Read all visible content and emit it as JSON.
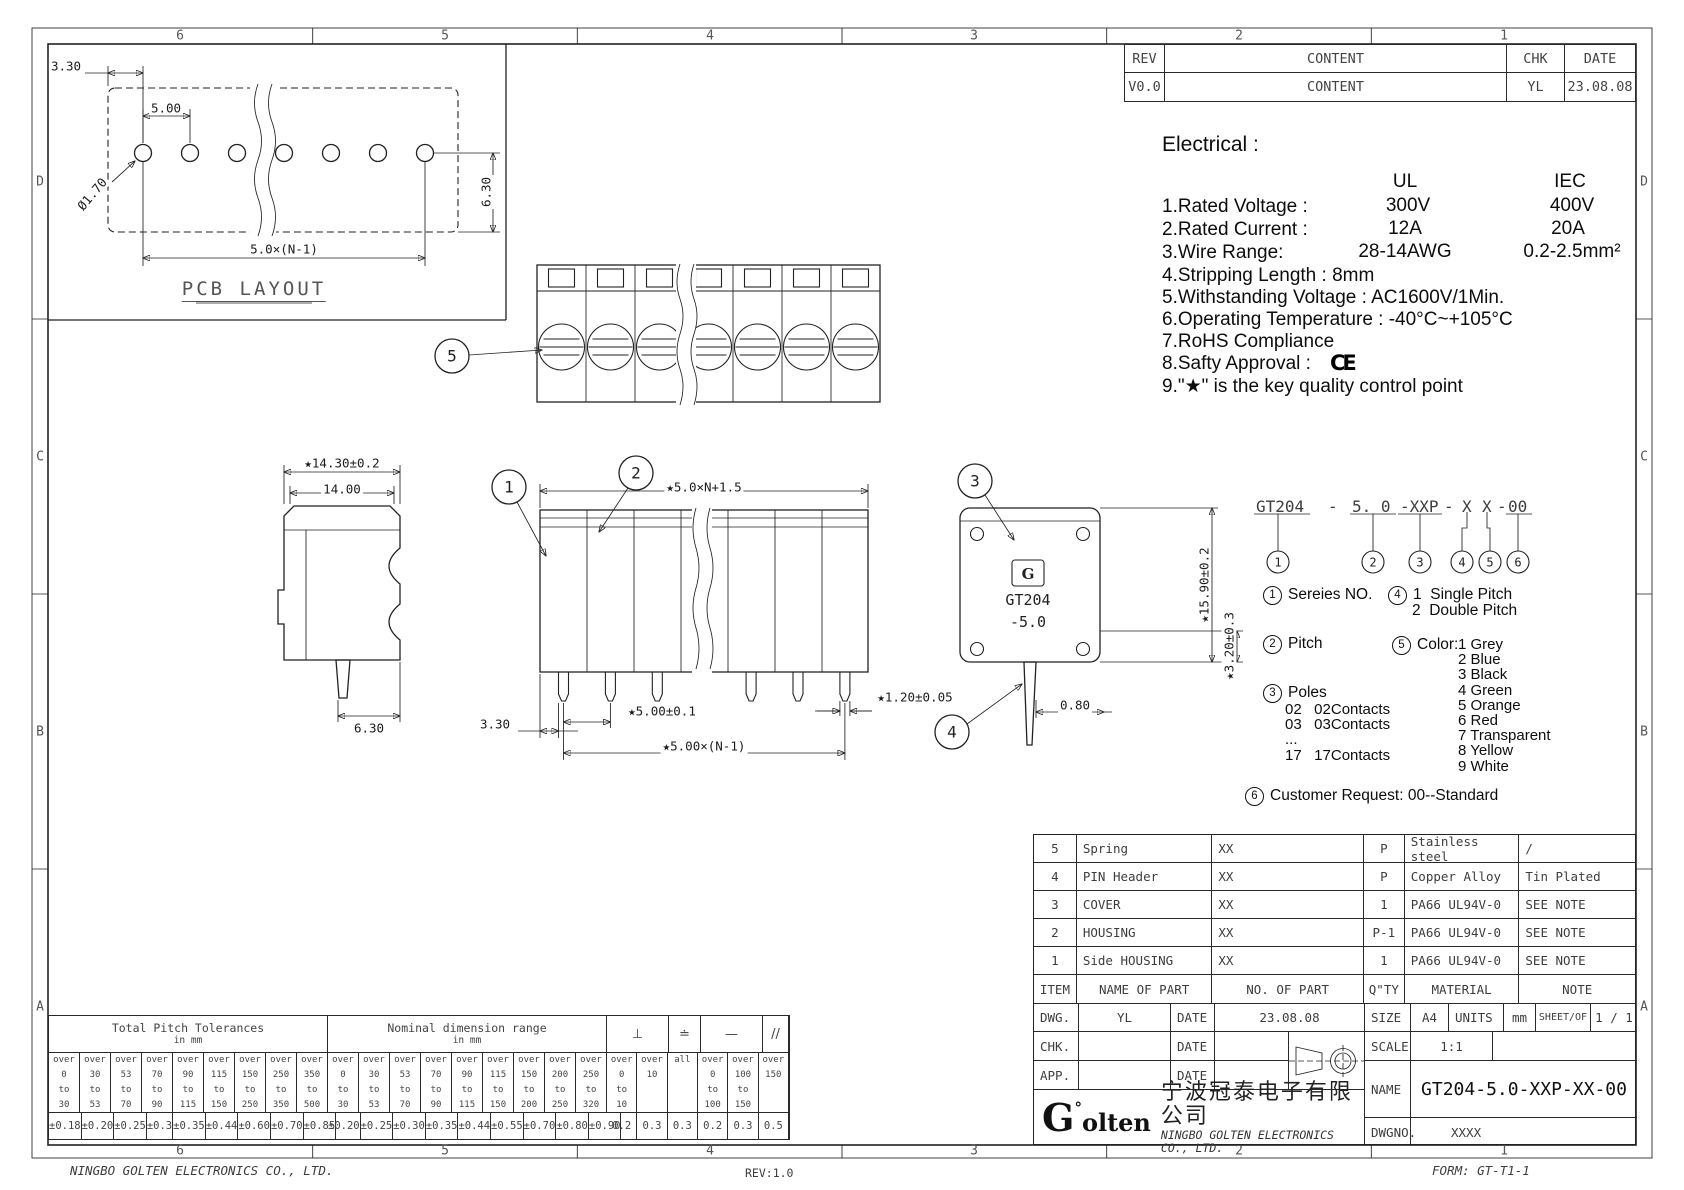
{
  "sheet": {
    "footer_left": "NINGBO GOLTEN ELECTRONICS CO., LTD.",
    "footer_center": "REV:1.0",
    "footer_right": "FORM: GT-T1-1",
    "zone_cols": [
      "6",
      "5",
      "4",
      "3",
      "2",
      "1"
    ],
    "zone_rows": [
      "D",
      "C",
      "B",
      "A"
    ]
  },
  "rev_table": {
    "col_rev": "REV",
    "col_content": "CONTENT",
    "col_chk": "CHK",
    "col_date": "DATE",
    "row_rev": "V0.0",
    "row_content": "CONTENT",
    "row_chk": "YL",
    "row_date": "23.08.08"
  },
  "electrical": {
    "title": "Electrical :",
    "col_ul": "UL",
    "col_iec": "IEC",
    "r1_label": "1.Rated Voltage :",
    "r1_ul": "300V",
    "r1_iec": "400V",
    "r2_label": "2.Rated Current :",
    "r2_ul": "12A",
    "r2_iec": "20A",
    "r3_label": "3.Wire Range:",
    "r3_ul": "28-14AWG",
    "r3_iec": "0.2-2.5mm²",
    "l4": "4.Stripping Length : 8mm",
    "l5": "5.Withstanding Voltage : AC1600V/1Min.",
    "l6": "6.Operating Temperature : -40°C~+105°C",
    "l7": "7.RoHS Compliance",
    "l8": "8.Safty Approval :",
    "ce": "CE",
    "l9": "9.\"★\" is the key quality control point"
  },
  "views": {
    "pcb": {
      "title": "PCB LAYOUT",
      "d330": "3.30",
      "d500": "5.00",
      "d170": "Ø1.70",
      "d630": "6.30",
      "dpitch": "5.0×(N-1)"
    },
    "side": {
      "d1430": "★14.30±0.2",
      "d1400": "14.00",
      "d630": "6.30"
    },
    "long": {
      "dtop": "★5.0×N+1.5",
      "d330": "3.30",
      "d500": "★5.00±0.1",
      "dpitch": "★5.00×(N-1)",
      "d120": "★1.20±0.05"
    },
    "end": {
      "d1590": "★15.90±0.2",
      "d320": "★3.20±0.3",
      "d080": "0.80",
      "label1": "GT204",
      "label2": "-5.0",
      "logo": "G"
    }
  },
  "callouts": {
    "c1": "1",
    "c2": "2",
    "c3": "3",
    "c4": "4",
    "c5": "5"
  },
  "part_code": {
    "segments": [
      "GT204",
      "-",
      "5. 0",
      "-XXP",
      "-",
      "X",
      "X",
      "-",
      "00"
    ],
    "markers": [
      "1",
      "2",
      "3",
      "4",
      "5",
      "6"
    ]
  },
  "legend": {
    "s1_num": "1",
    "s1": "Sereies NO.",
    "s2_num": "2",
    "s2": "Pitch",
    "s3_num": "3",
    "s3": "Poles",
    "s3_rows": [
      "02   02Contacts",
      "03   03Contacts",
      "...",
      "17   17Contacts"
    ],
    "s4_num": "4",
    "s4_l1": "1  Single Pitch",
    "s4_l2": "2  Double Pitch",
    "s5_num": "5",
    "s5": "Color:",
    "s5_items": [
      "1 Grey",
      "2 Blue",
      "3 Black",
      "4 Green",
      "5 Orange",
      "6 Red",
      "7 Transparent",
      "8 Yellow",
      "9 White"
    ],
    "s6_num": "6",
    "s6": "Customer Request: 00--Standard"
  },
  "bom": {
    "header": [
      "ITEM",
      "NAME OF PART",
      "NO. OF PART",
      "Q\"TY",
      "MATERIAL",
      "NOTE"
    ],
    "rows": [
      [
        "5",
        "Spring",
        "XX",
        "P",
        "Stainless steel",
        "/"
      ],
      [
        "4",
        "PIN Header",
        "XX",
        "P",
        "Copper Alloy",
        "Tin Plated"
      ],
      [
        "3",
        "COVER",
        "XX",
        "1",
        "PA66 UL94V-0",
        "SEE NOTE"
      ],
      [
        "2",
        "HOUSING",
        "XX",
        "P-1",
        "PA66 UL94V-0",
        "SEE NOTE"
      ],
      [
        "1",
        "Side HOUSING",
        "XX",
        "1",
        "PA66 UL94V-0",
        "SEE NOTE"
      ]
    ]
  },
  "title_block": {
    "dwg": "DWG.",
    "dwg_by": "YL",
    "date1": "DATE",
    "dwg_date": "23.08.08",
    "size": "SIZE",
    "size_v": "A4",
    "units": "UNITS",
    "units_v": "mm",
    "sheet": "SHEET/OF",
    "sheet_v": "1 / 1",
    "chk": "CHK.",
    "date2": "DATE",
    "scale": "SCALE",
    "scale_v": "1:1",
    "app": "APP.",
    "date3": "DATE",
    "name": "NAME",
    "name_v": "GT204-5.0-XXP-XX-00",
    "logo_g": "G",
    "logo_rest": "olten",
    "logo_mark": "°",
    "company_cn": "宁波冠泰电子有限公司",
    "company_en": "NINGBO GOLTEN ELECTRONICS CO., LTD.",
    "dwgno": "DWGNO.",
    "dwgno_v": "XXXX"
  },
  "tol_table": {
    "g1_title": "Total Pitch Tolerances",
    "g1_sub": "in mm",
    "g2_title": "Nominal dimension range",
    "g2_sub": "in mm",
    "sym1": "⊥",
    "sym2": "≐",
    "sym3": "—",
    "sym4": "//",
    "g1": [
      {
        "w1": "over",
        "v1": "0",
        "w2": "to",
        "v2": "30",
        "tol": "±0.18"
      },
      {
        "w1": "over",
        "v1": "30",
        "w2": "to",
        "v2": "53",
        "tol": "±0.20"
      },
      {
        "w1": "over",
        "v1": "53",
        "w2": "to",
        "v2": "70",
        "tol": "±0.25"
      },
      {
        "w1": "over",
        "v1": "70",
        "w2": "to",
        "v2": "90",
        "tol": "±0.3"
      },
      {
        "w1": "over",
        "v1": "90",
        "w2": "to",
        "v2": "115",
        "tol": "±0.35"
      },
      {
        "w1": "over",
        "v1": "115",
        "w2": "to",
        "v2": "150",
        "tol": "±0.44"
      },
      {
        "w1": "over",
        "v1": "150",
        "w2": "to",
        "v2": "250",
        "tol": "±0.60"
      },
      {
        "w1": "over",
        "v1": "250",
        "w2": "to",
        "v2": "350",
        "tol": "±0.70"
      },
      {
        "w1": "over",
        "v1": "350",
        "w2": "to",
        "v2": "500",
        "tol": "±0.85"
      }
    ],
    "g2": [
      {
        "w1": "over",
        "v1": "0",
        "w2": "to",
        "v2": "30",
        "tol": "±0.20"
      },
      {
        "w1": "over",
        "v1": "30",
        "w2": "to",
        "v2": "53",
        "tol": "±0.25"
      },
      {
        "w1": "over",
        "v1": "53",
        "w2": "to",
        "v2": "70",
        "tol": "±0.30"
      },
      {
        "w1": "over",
        "v1": "70",
        "w2": "to",
        "v2": "90",
        "tol": "±0.35"
      },
      {
        "w1": "over",
        "v1": "90",
        "w2": "to",
        "v2": "115",
        "tol": "±0.44"
      },
      {
        "w1": "over",
        "v1": "115",
        "w2": "to",
        "v2": "150",
        "tol": "±0.55"
      },
      {
        "w1": "over",
        "v1": "150",
        "w2": "to",
        "v2": "200",
        "tol": "±0.70"
      },
      {
        "w1": "over",
        "v1": "200",
        "w2": "to",
        "v2": "250",
        "tol": "±0.80"
      },
      {
        "w1": "over",
        "v1": "250",
        "w2": "to",
        "v2": "320",
        "tol": "±0.90"
      }
    ],
    "sym_cols": [
      {
        "w1": "over",
        "v1": "0",
        "w2": "to",
        "v2": "10",
        "tol": "0.2"
      },
      {
        "w1": "over",
        "v1": "10",
        "w2": "",
        "v2": "",
        "tol": "0.3"
      },
      {
        "w1": "all",
        "v1": "",
        "w2": "",
        "v2": "",
        "tol": "0.3"
      },
      {
        "w1": "over",
        "v1": "0",
        "w2": "to",
        "v2": "100",
        "tol": "0.2"
      },
      {
        "w1": "over",
        "v1": "100",
        "w2": "to",
        "v2": "150",
        "tol": "0.3"
      },
      {
        "w1": "over",
        "v1": "150",
        "w2": "",
        "v2": "",
        "tol": "0.5"
      }
    ]
  },
  "colors": {
    "line": "#222222",
    "cad_text": "#3d3d3d",
    "paper": "#ffffff"
  }
}
